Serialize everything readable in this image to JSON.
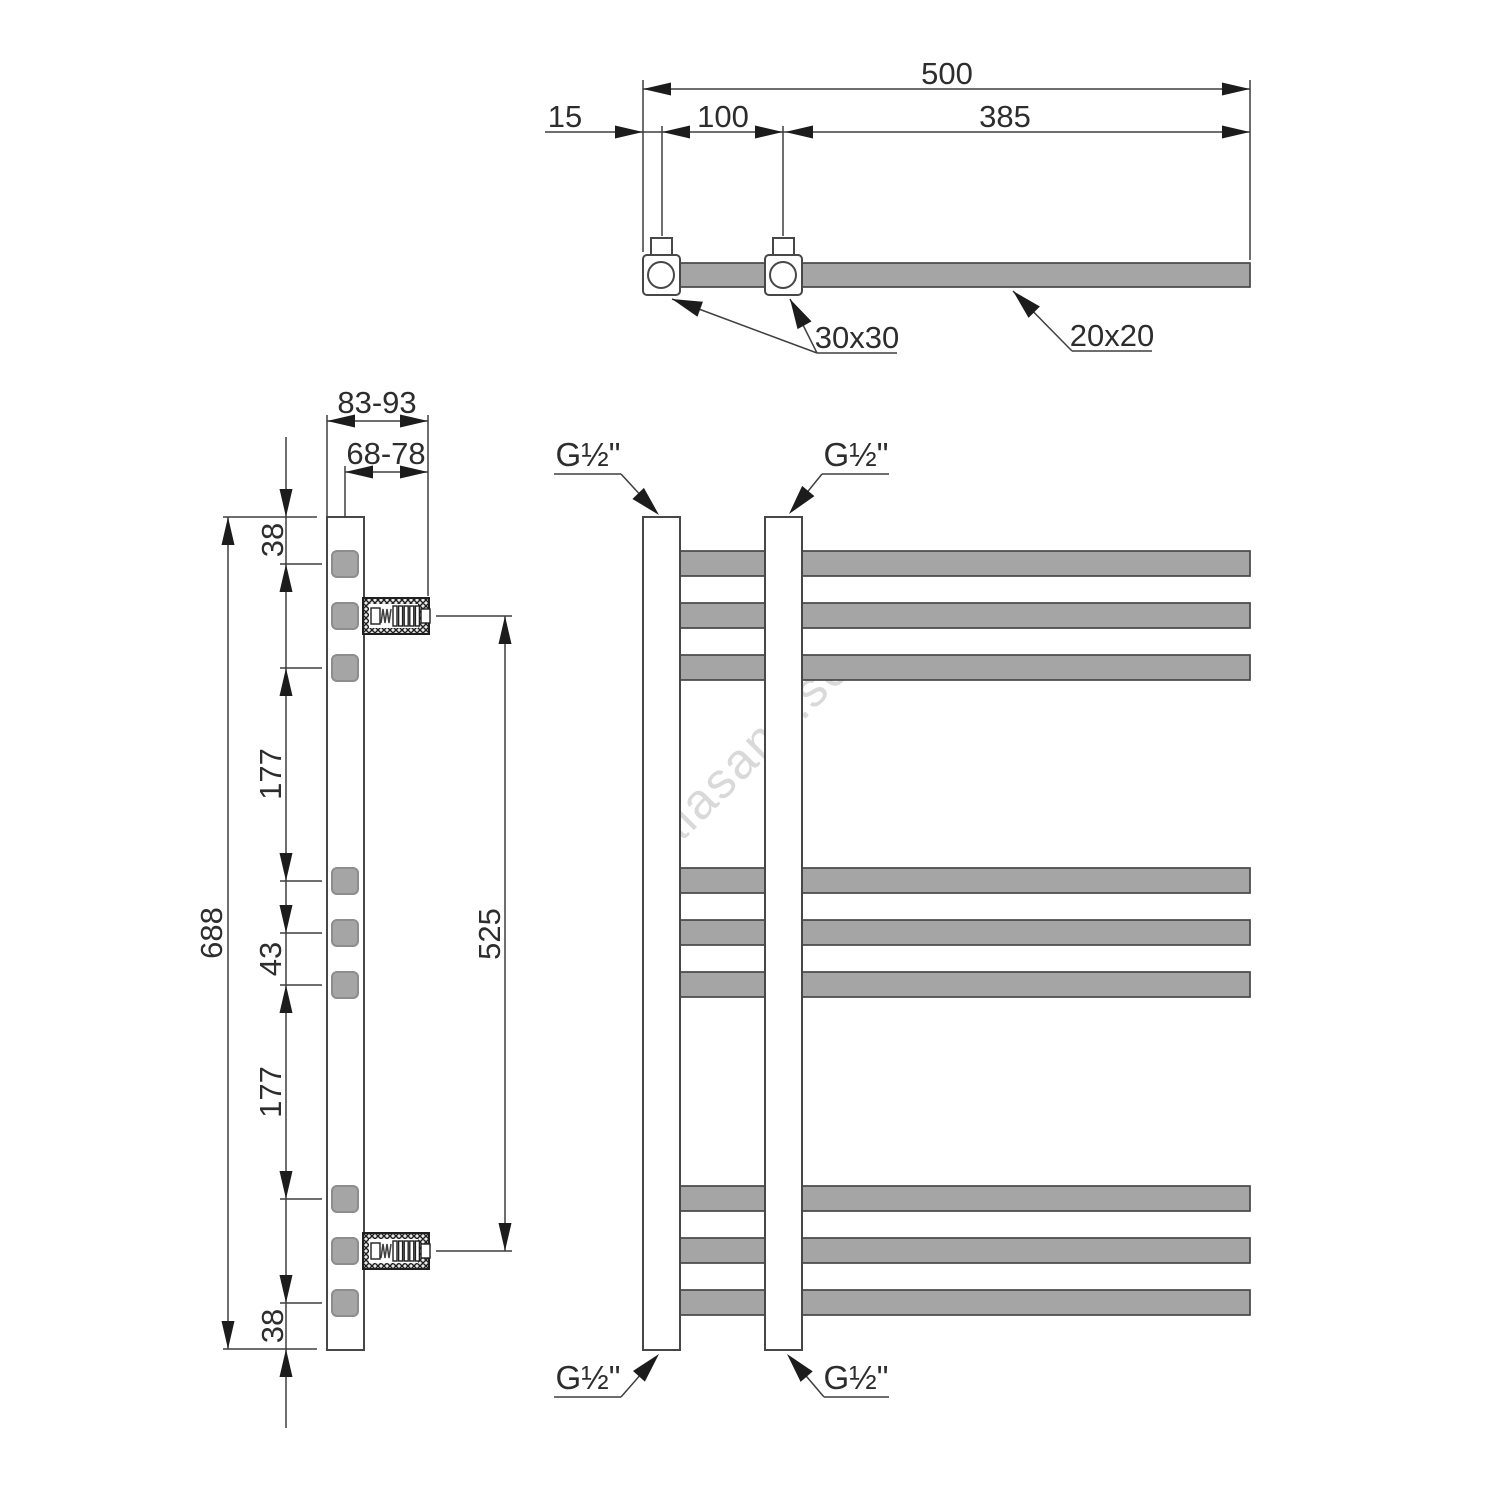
{
  "watermark": {
    "text": "alasans.se"
  },
  "colors": {
    "line": "#3f3f3f",
    "edge": "#474747",
    "arrow": "#1c1c1c",
    "text": "#2d2d2d",
    "metal": "#a5a5a5",
    "watermark": "#d9d9d9"
  },
  "top_view": {
    "dim_overall_width": "500",
    "dim_edge_to_first_connection": "15",
    "dim_connection_spacing": "100",
    "dim_connection_to_edge": "385",
    "label_collector_profile": "30x30",
    "label_rail_profile": "20x20"
  },
  "side_view": {
    "dim_wall_distance_outer": "83-93",
    "dim_wall_distance_axis": "68-78",
    "dim_top_to_first_rail": "38",
    "dim_upper_gap": "177",
    "dim_rail_pitch": "43",
    "dim_lower_gap": "177",
    "dim_last_rail_to_bottom": "38",
    "dim_overall_height": "688",
    "dim_bracket_spacing": "525"
  },
  "front_view": {
    "fitting_top_left": "G½\"",
    "fitting_top_right": "G½\"",
    "fitting_bottom_left": "G½\"",
    "fitting_bottom_right": "G½\""
  }
}
